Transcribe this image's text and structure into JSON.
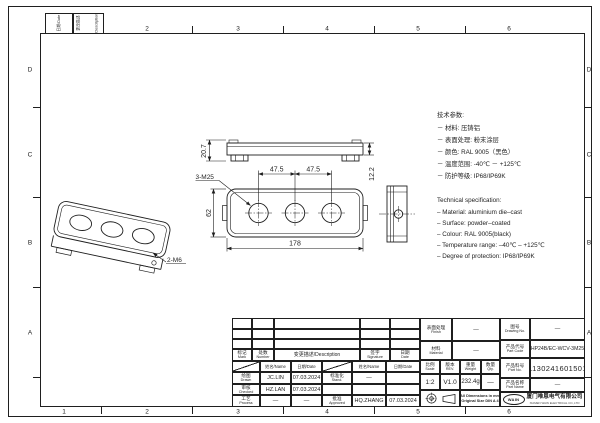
{
  "frame": {
    "cols": [
      "1",
      "2",
      "3",
      "4",
      "5",
      "6"
    ],
    "rows": [
      "D",
      "C",
      "B",
      "A"
    ],
    "corner_date": "日期/Date",
    "corner_desc_cn": "更改描述",
    "corner_desc_en": "Description"
  },
  "notes_cn": {
    "title": "技术参数:",
    "items": [
      "－ 材料: 压铸铝",
      "－ 表面处理: 粉末涂层",
      "－ 颜色: RAL 9005（黑色）",
      "－ 温度范围: -40℃ － +125℃",
      "－ 防护等级: IP68/IP69K"
    ]
  },
  "notes_en": {
    "title": "Technical specification:",
    "items": [
      "– Material: aluminium die–cast",
      "– Surface: powder–coated",
      "– Colour: RAL 9005(black)",
      "– Temperature range: –40℃ – +125℃",
      "– Degree of protection: IP68/IP69K"
    ]
  },
  "views": {
    "side_view": {
      "dim_total_height": "20.7",
      "dim_body_height": "12.2"
    },
    "front_view": {
      "dim_hole_label": "3-M25",
      "dim_pitch_left": "47.5",
      "dim_pitch_right": "47.5",
      "dim_height": "62",
      "dim_width": "178"
    },
    "iso_view": {
      "dim_hole_label": "2-M6"
    }
  },
  "title_block": {
    "rev_headers": {
      "mark_cn": "标记",
      "mark_en": "Mark",
      "number_cn": "处数",
      "number_en": "Number",
      "description": "变更描述/Description",
      "sign_cn": "签字",
      "sign_en": "Signature",
      "date_cn": "日期",
      "date_en": "Date"
    },
    "sign_table": {
      "name_header": "姓名/Name",
      "date_header": "日期/Date",
      "drawn_cn": "绘图",
      "drawn_en": "Drawn",
      "drawn_name": "JC.LIN",
      "drawn_date": "07.03.2024",
      "checked_cn": "审核",
      "checked_en": "Checked",
      "checked_name": "HZ.LAN",
      "checked_date": "07.03.2024",
      "process_cn": "工艺",
      "process_en": "Process",
      "process_name": "—",
      "process_date": "—",
      "stand_cn": "标准化",
      "stand_en": "Stand.",
      "stand_value": "—",
      "approved_cn": "批准",
      "approved_en": "Approved",
      "approved_name": "HQ.ZHANG",
      "approved_date": "07.03.2024"
    },
    "info": {
      "finish_cn": "表面处理",
      "finish_en": "Finish",
      "finish_value": "—",
      "material_cn": "材料",
      "material_en": "Material",
      "material_value": "—",
      "scale_cn": "比例",
      "scale_en": "Scale",
      "scale_value": "1:2",
      "rev_cn": "版本",
      "rev_en": "REV.",
      "rev_value": "V1.0",
      "weight_cn": "重量",
      "weight_en": "Weight",
      "weight_value": "232.4g",
      "qty_cn": "数量",
      "qty_en": "Qty.",
      "qty_value": "—",
      "note_line1": "All Dimensions in mm",
      "note_line2": "Original Size DIN A 4"
    },
    "ids": {
      "drawing_no_cn": "图号",
      "drawing_no_en": "Drawing No.",
      "drawing_no_value": "—",
      "part_code_cn": "产品代号",
      "part_code_en": "Part Code",
      "part_code_value": "HP24B/EC-WCV-3M25",
      "part_no_cn": "产品料号",
      "part_no_en": "Part No.",
      "part_no_value": "1130241601501",
      "part_name_cn": "产品名称",
      "part_name_en": "Part Name",
      "part_name_value": "—"
    },
    "company": {
      "logo": "WAIN",
      "name_cn": "厦门唯恩电气有限公司",
      "name_en": "XIAMEN WAIN ELECTRICAL CO.,LTD"
    }
  },
  "colors": {
    "line": "#1f1f1f",
    "paper": "#ffffff"
  },
  "icons": {
    "projection_front": "first-angle-projection-circles-icon",
    "projection_side": "first-angle-projection-cone-icon",
    "logo": "wain-oval-logo"
  }
}
